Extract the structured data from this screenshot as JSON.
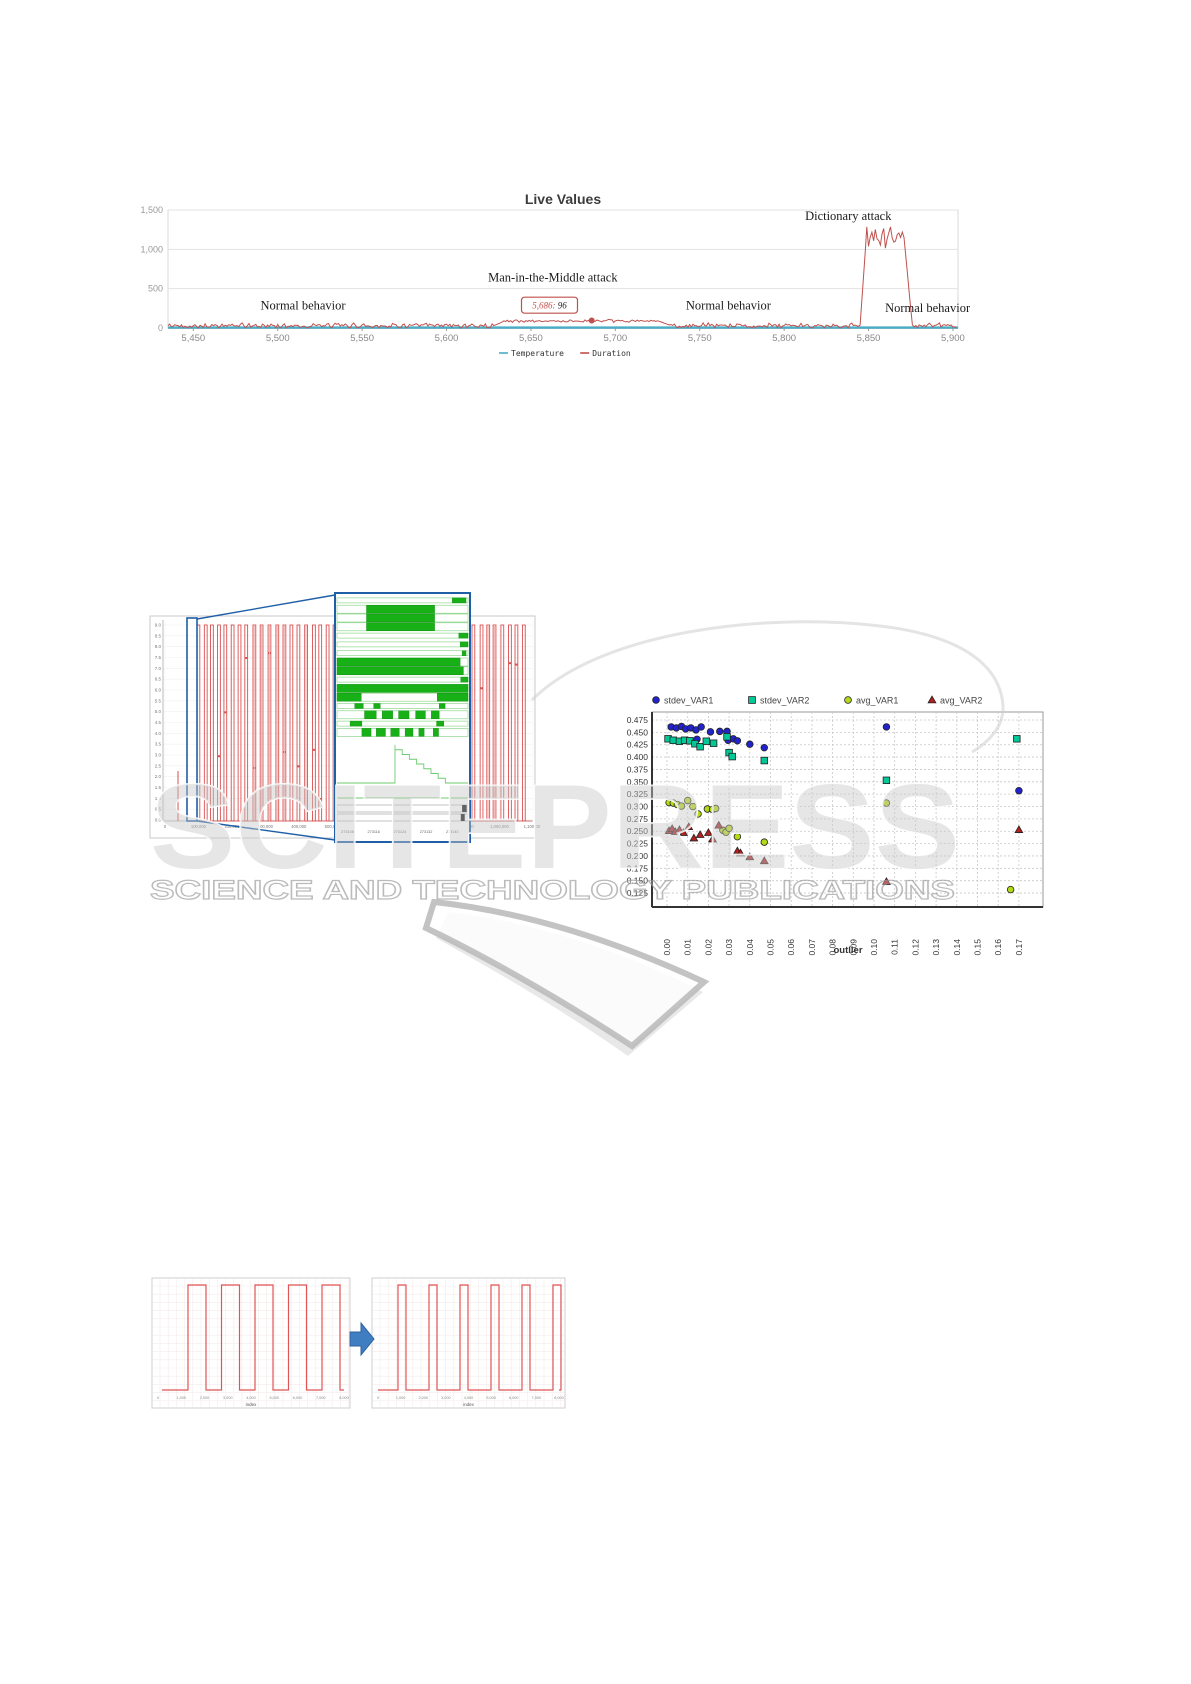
{
  "page": {
    "width": 1191,
    "height": 1684,
    "background": "#ffffff"
  },
  "watermark": {
    "big_text": "SCITEPRESS",
    "sub_text": "SCIENCE AND TECHNOLOGY PUBLICATIONS"
  },
  "chart_data": {
    "live": {
      "type": "line",
      "title": "Live Values",
      "x_domain": [
        5435,
        5903
      ],
      "y_domain": [
        0,
        1500
      ],
      "y_ticks": [
        {
          "v": 0,
          "label": "0"
        },
        {
          "v": 500,
          "label": "500"
        },
        {
          "v": 1000,
          "label": "1,000"
        },
        {
          "v": 1500,
          "label": "1,500"
        }
      ],
      "x_ticks": [
        {
          "v": 5450,
          "label": "5,450"
        },
        {
          "v": 5500,
          "label": "5,500"
        },
        {
          "v": 5550,
          "label": "5,550"
        },
        {
          "v": 5600,
          "label": "5,600"
        },
        {
          "v": 5650,
          "label": "5,650"
        },
        {
          "v": 5700,
          "label": "5,700"
        },
        {
          "v": 5750,
          "label": "5,750"
        },
        {
          "v": 5800,
          "label": "5,800"
        },
        {
          "v": 5850,
          "label": "5,850"
        },
        {
          "v": 5900,
          "label": "5,900"
        }
      ],
      "legend": [
        {
          "label": "Temperature",
          "color": "#4bacc6"
        },
        {
          "label": "Duration",
          "color": "#c0504d"
        }
      ],
      "series": {
        "temperature": {
          "color": "#4bacc6",
          "value": 6
        },
        "duration": {
          "color": "#c0504d",
          "seed": 42,
          "segments": [
            {
              "x0": 5435,
              "x1": 5628,
              "base": 28,
              "noise": 42
            },
            {
              "x0": 5628,
              "x1": 5634,
              "ramp": [
                30,
                85
              ]
            },
            {
              "x0": 5634,
              "x1": 5726,
              "base": 88,
              "noise": 22
            },
            {
              "x0": 5726,
              "x1": 5733,
              "ramp": [
                85,
                30
              ]
            },
            {
              "x0": 5733,
              "x1": 5845,
              "base": 28,
              "noise": 42
            },
            {
              "x0": 5845,
              "x1": 5849,
              "ramp": [
                35,
                1270
              ]
            },
            {
              "x0": 5849,
              "x1": 5871,
              "base": 1160,
              "noise": 190
            },
            {
              "x0": 5871,
              "x1": 5876,
              "ramp": [
                1150,
                25
              ]
            },
            {
              "x0": 5876,
              "x1": 5903,
              "base": 30,
              "noise": 42
            }
          ]
        }
      },
      "annotations": [
        {
          "text": "Normal behavior",
          "x": 5515,
          "y": 235
        },
        {
          "text": "Man-in-the-Middle attack",
          "x": 5663,
          "y": 590
        },
        {
          "text": "Normal behavior",
          "x": 5767,
          "y": 235
        },
        {
          "text": "Dictionary attack",
          "x": 5838,
          "y": 1370
        },
        {
          "text": "Normal behavior",
          "x": 5885,
          "y": 205
        }
      ],
      "tooltip": {
        "x_label": "5,686:",
        "y_label": "96",
        "x": 5661,
        "y": 290
      },
      "marker": {
        "x": 5686,
        "y": 96
      }
    },
    "pulse_overview": {
      "type": "pulse-line",
      "color": "#d94f4f",
      "seed": 11,
      "pulse_high": "9.0",
      "y_ticks": [
        "9.0",
        "8.5",
        "8.0",
        "7.5",
        "7.0",
        "6.5",
        "6.0",
        "5.5",
        "5.0",
        "4.5",
        "4.0",
        "3.5",
        "3.0",
        "2.5",
        "2.0",
        "1.5",
        "1.0",
        "0.5",
        "0.0"
      ],
      "x_ticks": [
        "0",
        "100,000",
        "200,000",
        "300,000",
        "400,000",
        "500,000",
        "600,000",
        "700,000",
        "800,000",
        "900,000",
        "1,000,000",
        "1,100,000"
      ],
      "selection_color": "#1f5fa8"
    },
    "inset": {
      "type": "gantt",
      "bar_color": "#17b117",
      "border_color": "#1f5fa8",
      "rows": [
        {
          "kind": "thin",
          "seg": [
            [
              0.88,
              0.985
            ]
          ]
        },
        {
          "kind": "bar",
          "seg": [
            [
              0.225,
              0.745
            ]
          ]
        },
        {
          "kind": "bar",
          "seg": [
            [
              0.225,
              0.745
            ]
          ]
        },
        {
          "kind": "bar",
          "seg": [
            [
              0.225,
              0.745
            ]
          ]
        },
        {
          "kind": "thin",
          "seg": [
            [
              0.93,
              1
            ]
          ]
        },
        {
          "kind": "thin",
          "seg": [
            [
              0.94,
              1
            ]
          ]
        },
        {
          "kind": "thin",
          "seg": [
            [
              0.955,
              0.985
            ]
          ]
        },
        {
          "kind": "bar",
          "seg": [
            [
              0,
              0.94
            ]
          ]
        },
        {
          "kind": "bar",
          "seg": [
            [
              0,
              0.965
            ]
          ]
        },
        {
          "kind": "thin",
          "seg": [
            [
              0.945,
              1
            ]
          ]
        },
        {
          "kind": "bar",
          "seg": [
            [
              0,
              1
            ]
          ]
        },
        {
          "kind": "bar",
          "seg": [
            [
              0,
              0.185
            ],
            [
              0.765,
              1
            ]
          ]
        },
        {
          "kind": "thin",
          "seg": [
            [
              0.135,
              0.2
            ],
            [
              0.28,
              0.33
            ],
            [
              0.78,
              0.825
            ]
          ]
        },
        {
          "kind": "bar",
          "seg": [
            [
              0.21,
              0.3
            ],
            [
              0.345,
              0.425
            ],
            [
              0.47,
              0.55
            ],
            [
              0.6,
              0.675
            ],
            [
              0.72,
              0.78
            ]
          ]
        },
        {
          "kind": "thin",
          "seg": [
            [
              0.1,
              0.19
            ],
            [
              0.76,
              0.815
            ]
          ]
        },
        {
          "kind": "bar",
          "seg": [
            [
              0.19,
              0.26
            ],
            [
              0.3,
              0.37
            ],
            [
              0.41,
              0.475
            ],
            [
              0.52,
              0.58
            ],
            [
              0.625,
              0.665
            ],
            [
              0.735,
              0.775
            ]
          ]
        }
      ],
      "x_ticks": [
        "273108",
        "273116",
        "273124",
        "273132",
        "273140"
      ]
    },
    "scatter": {
      "type": "scatter",
      "xlabel": "outlier",
      "x_ticks": [
        "0.00",
        "0.01",
        "0.02",
        "0.03",
        "0.04",
        "0.05",
        "0.06",
        "0.07",
        "0.08",
        "0.09",
        "0.10",
        "0.11",
        "0.12",
        "0.13",
        "0.14",
        "0.15",
        "0.16",
        "0.17"
      ],
      "y_ticks": [
        "0.475",
        "0.450",
        "0.425",
        "0.400",
        "0.375",
        "0.350",
        "0.325",
        "0.300",
        "0.275",
        "0.250",
        "0.225",
        "0.200",
        "0.175",
        "0.150",
        "0.125"
      ],
      "series": [
        {
          "name": "stdev_VAR1",
          "marker": "circle",
          "color": "#2323cd",
          "points": [
            [
              0.002,
              0.461
            ],
            [
              0.0045,
              0.459
            ],
            [
              0.007,
              0.462
            ],
            [
              0.009,
              0.457
            ],
            [
              0.0115,
              0.459
            ],
            [
              0.014,
              0.455
            ],
            [
              0.0165,
              0.461
            ],
            [
              0.021,
              0.451
            ],
            [
              0.0255,
              0.452
            ],
            [
              0.029,
              0.452
            ],
            [
              0.0145,
              0.436
            ],
            [
              0.0295,
              0.434
            ],
            [
              0.032,
              0.437
            ],
            [
              0.034,
              0.433
            ],
            [
              0.04,
              0.426
            ],
            [
              0.047,
              0.419
            ],
            [
              0.106,
              0.461
            ],
            [
              0.17,
              0.332
            ]
          ]
        },
        {
          "name": "stdev_VAR2",
          "marker": "square",
          "color": "#00c896",
          "points": [
            [
              0.0005,
              0.437
            ],
            [
              0.003,
              0.434
            ],
            [
              0.006,
              0.432
            ],
            [
              0.0085,
              0.434
            ],
            [
              0.011,
              0.433
            ],
            [
              0.0135,
              0.427
            ],
            [
              0.016,
              0.421
            ],
            [
              0.019,
              0.432
            ],
            [
              0.0225,
              0.428
            ],
            [
              0.029,
              0.441
            ],
            [
              0.03,
              0.409
            ],
            [
              0.0315,
              0.401
            ],
            [
              0.047,
              0.393
            ],
            [
              0.106,
              0.353
            ],
            [
              0.169,
              0.437
            ]
          ]
        },
        {
          "name": "avg_VAR1",
          "marker": "circle",
          "color": "#b4d918",
          "points": [
            [
              0.001,
              0.308
            ],
            [
              0.003,
              0.307
            ],
            [
              0.005,
              0.304
            ],
            [
              0.007,
              0.301
            ],
            [
              0.01,
              0.312
            ],
            [
              0.0125,
              0.3
            ],
            [
              0.015,
              0.285
            ],
            [
              0.0195,
              0.295
            ],
            [
              0.022,
              0.294
            ],
            [
              0.0235,
              0.296
            ],
            [
              0.027,
              0.252
            ],
            [
              0.0285,
              0.248
            ],
            [
              0.03,
              0.256
            ],
            [
              0.034,
              0.239
            ],
            [
              0.047,
              0.228
            ],
            [
              0.106,
              0.307
            ],
            [
              0.166,
              0.132
            ]
          ]
        },
        {
          "name": "avg_VAR2",
          "marker": "triangle",
          "color": "#b22020",
          "points": [
            [
              0.001,
              0.251
            ],
            [
              0.0025,
              0.255
            ],
            [
              0.004,
              0.249
            ],
            [
              0.006,
              0.253
            ],
            [
              0.008,
              0.247
            ],
            [
              0.0105,
              0.259
            ],
            [
              0.013,
              0.236
            ],
            [
              0.016,
              0.243
            ],
            [
              0.02,
              0.247
            ],
            [
              0.022,
              0.234
            ],
            [
              0.025,
              0.262
            ],
            [
              0.034,
              0.21
            ],
            [
              0.0355,
              0.206
            ],
            [
              0.04,
              0.198
            ],
            [
              0.047,
              0.19
            ],
            [
              0.106,
              0.148
            ],
            [
              0.17,
              0.253
            ]
          ]
        }
      ]
    },
    "wave_before": {
      "type": "line",
      "color": "#e05555",
      "xlabel": "index",
      "pulse_count": 5,
      "x_ticks": [
        "0",
        "1,000",
        "2,000",
        "3,000",
        "4,000",
        "5,000",
        "6,000",
        "7,000",
        "8,000"
      ]
    },
    "wave_after": {
      "type": "line",
      "color": "#e05555",
      "xlabel": "index",
      "pulse_count": 6,
      "x_ticks": [
        "0",
        "1,000",
        "2,000",
        "3,000",
        "4,000",
        "5,000",
        "6,000",
        "7,000",
        "8,000"
      ]
    }
  }
}
